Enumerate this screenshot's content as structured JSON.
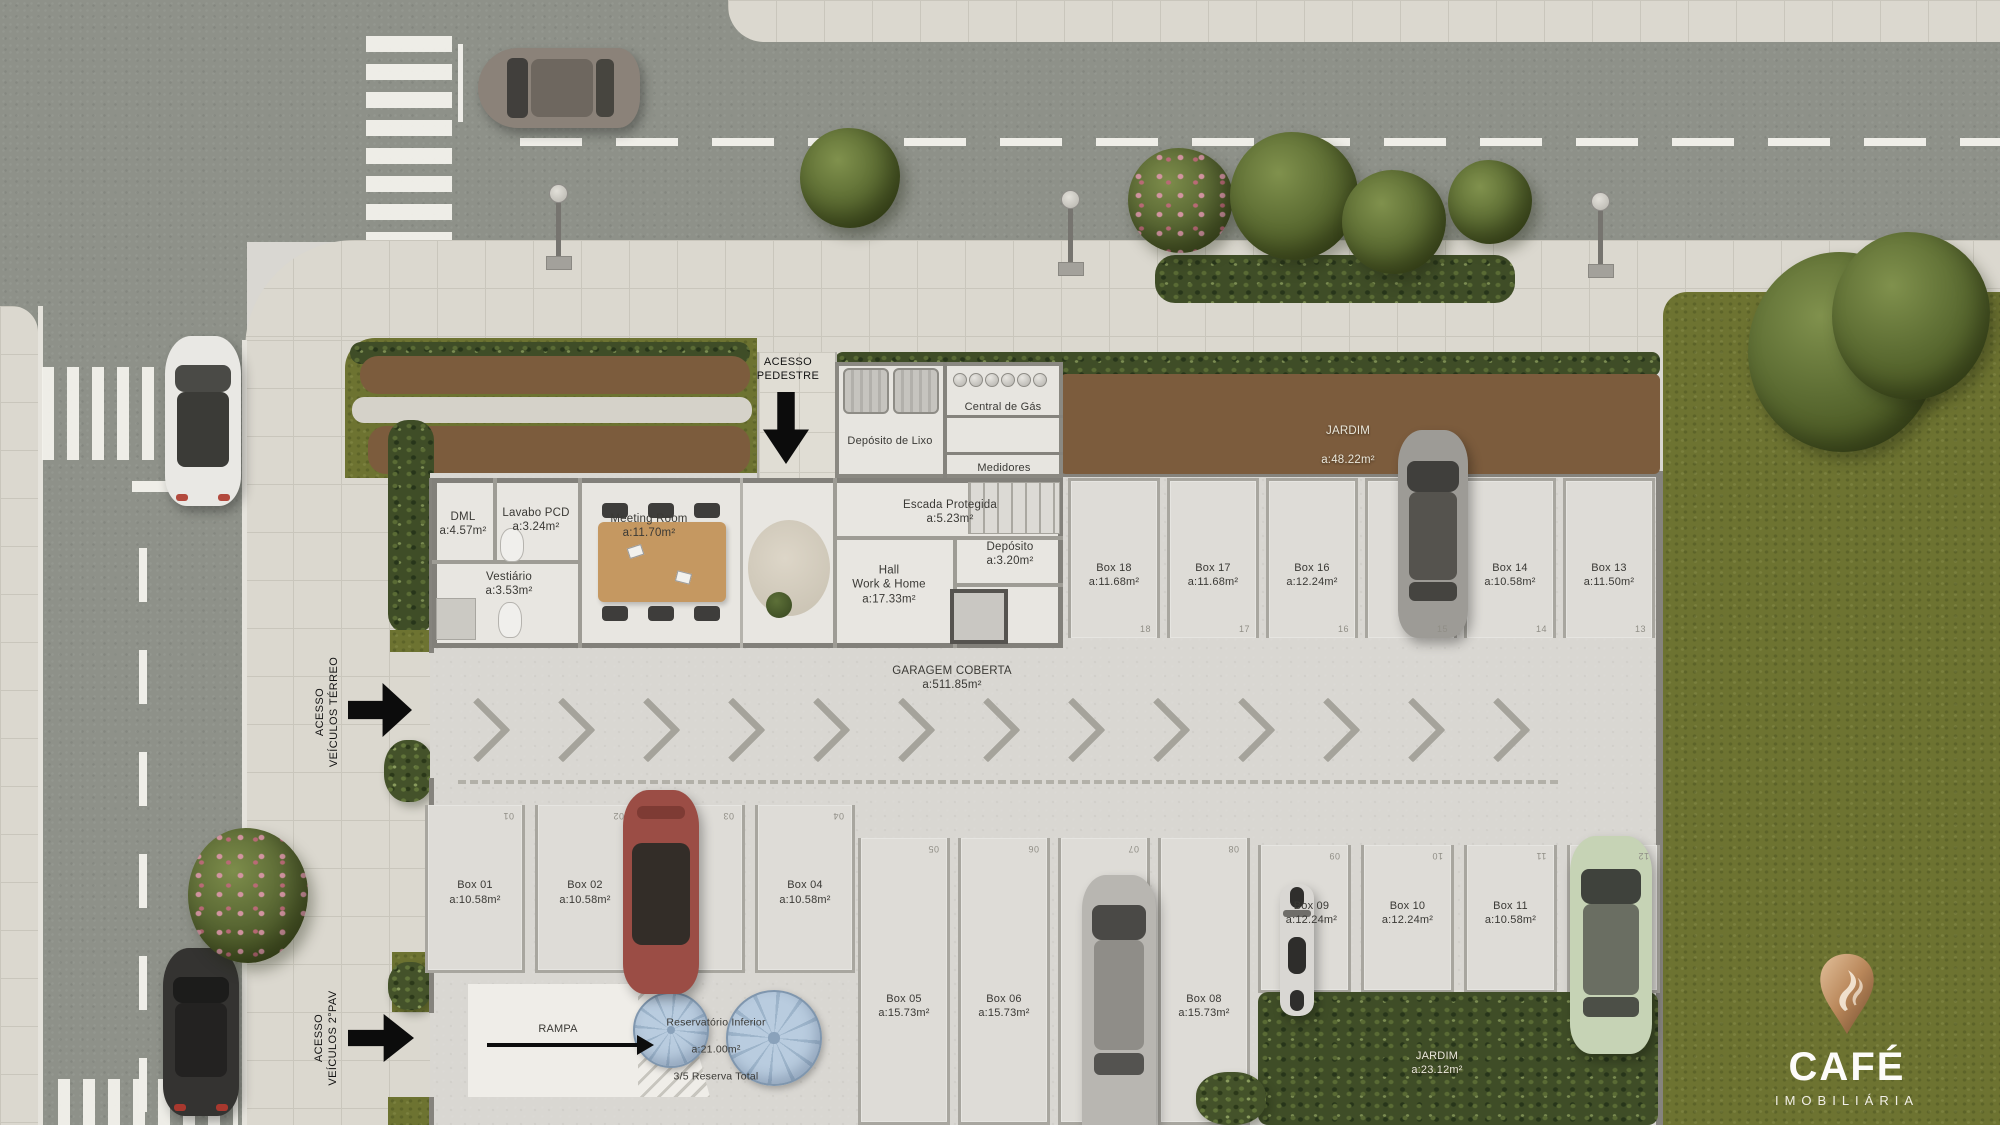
{
  "scene": {
    "access": {
      "pedestrian": "ACESSO\nPEDESTRE",
      "vehicles_ground": "ACESSO\nVEÍCULOS TÉRREO",
      "vehicles_upper": "ACESSO\nVEÍCULOS 2°PAV"
    },
    "rooms": {
      "dml": {
        "name": "DML",
        "area": "a:4.57m²"
      },
      "lavabo_pcd": {
        "name": "Lavabo PCD",
        "area": "a:3.24m²"
      },
      "meeting_room": {
        "name": "Meeting Room",
        "area": "a:11.70m²"
      },
      "vestiario": {
        "name": "Vestiário",
        "area": "a:3.53m²"
      },
      "hall": {
        "name": "Hall\nWork & Home",
        "area": "a:17.33m²"
      },
      "escada": {
        "name": "Escada Protegida",
        "area": "a:5.23m²"
      },
      "deposito": {
        "name": "Depósito",
        "area": "a:3.20m²"
      },
      "deposito_lixo": {
        "name": "Depósito de Lixo"
      },
      "central_gas": {
        "name": "Central de Gás"
      },
      "medidores": {
        "name": "Medidores"
      }
    },
    "garage": {
      "title": "GARAGEM COBERTA",
      "title_area": "a:511.85m²",
      "ramp_label": "RAMPA",
      "reservoir": {
        "name": "Reservatório Inferior",
        "area": "a:21.00m²",
        "note": "3/5 Reserva Total"
      },
      "jardim_top": {
        "name": "JARDIM",
        "area": "a:48.22m²"
      },
      "jardim_bottom": {
        "name": "JARDIM",
        "area": "a:23.12m²"
      },
      "boxes_top": [
        {
          "name": "Box 18",
          "area": "a:11.68m²",
          "num": "18"
        },
        {
          "name": "Box 17",
          "area": "a:11.68m²",
          "num": "17"
        },
        {
          "name": "Box 16",
          "area": "a:12.24m²",
          "num": "16"
        },
        {
          "name": "Box 15",
          "area": "a:12.24m²",
          "num": "15"
        },
        {
          "name": "Box 14",
          "area": "a:10.58m²",
          "num": "14"
        },
        {
          "name": "Box 13",
          "area": "a:11.50m²",
          "num": "13"
        }
      ],
      "boxes_left": [
        {
          "name": "Box 01",
          "area": "a:10.58m²",
          "num": "01"
        },
        {
          "name": "Box 02",
          "area": "a:10.58m²",
          "num": "02"
        },
        {
          "name": "Box 03",
          "area": "a:10.58m²",
          "num": "03"
        },
        {
          "name": "Box 04",
          "area": "a:10.58m²",
          "num": "04"
        }
      ],
      "boxes_middle": [
        {
          "name": "Box 05",
          "area": "a:15.73m²",
          "num": "05"
        },
        {
          "name": "Box 06",
          "area": "a:15.73m²",
          "num": "06"
        },
        {
          "name": "Box 07",
          "area": "a:15.73m²",
          "num": "07"
        },
        {
          "name": "Box 08",
          "area": "a:15.73m²",
          "num": "08"
        }
      ],
      "boxes_right": [
        {
          "name": "Box 09",
          "area": "a:12.24m²",
          "num": "09"
        },
        {
          "name": "Box 10",
          "area": "a:12.24m²",
          "num": "10"
        },
        {
          "name": "Box 11",
          "area": "a:10.58m²",
          "num": "11"
        },
        {
          "name": "Box 12",
          "area": "a:11.50m²",
          "num": "12"
        }
      ]
    },
    "logo": {
      "brand": "CAFÉ",
      "subtitle": "IMOBILIÁRIA"
    },
    "colors": {
      "lawn": "#6d7331",
      "road": "#8e9189",
      "sidewalk": "#dbd8cf",
      "garage_floor": "#d9d7d2",
      "shrub_brown": "#7c5c3d",
      "hedge_green": "#3f4d27",
      "logo_bronze": "#b9875a",
      "label_ink": "#3a3935"
    }
  }
}
